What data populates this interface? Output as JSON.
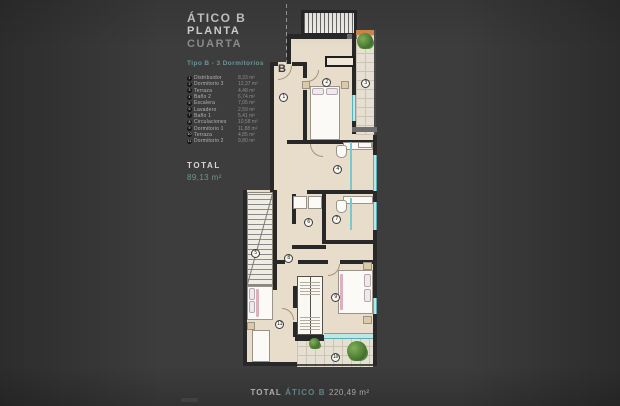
{
  "header": {
    "title": "ÁTICO B",
    "subtitle_primary": "PLANTA",
    "subtitle_accent": "CUARTA",
    "type_line": "Tipo B - 3 Dormitorios"
  },
  "legend": {
    "items": [
      {
        "num": "1",
        "name": "Distribuidor",
        "area": "8,33 m²"
      },
      {
        "num": "2",
        "name": "Dormitorio 3",
        "area": "12,37 m²"
      },
      {
        "num": "3",
        "name": "Terraza",
        "area": "4,48 m²"
      },
      {
        "num": "4",
        "name": "Baño 2",
        "area": "6,74 m²"
      },
      {
        "num": "5",
        "name": "Escalera",
        "area": "7,05 m²"
      },
      {
        "num": "6",
        "name": "Lavadero",
        "area": "2,59 m²"
      },
      {
        "num": "7",
        "name": "Baño 1",
        "area": "5,41 m²"
      },
      {
        "num": "8",
        "name": "Circulaciones",
        "area": "10,58 m²"
      },
      {
        "num": "9",
        "name": "Dormitorio 1",
        "area": "11,88 m²"
      },
      {
        "num": "10",
        "name": "Terraza",
        "area": "4,85 m²"
      },
      {
        "num": "11",
        "name": "Dormitorio 2",
        "area": "9,80 m²"
      }
    ]
  },
  "total": {
    "label": "TOTAL",
    "value": "89,13 m²"
  },
  "footer": {
    "label": "TOTAL",
    "accent": "ÁTICO B",
    "value": "220,49 m²"
  },
  "plan": {
    "section_marker": "B",
    "markers": [
      "1",
      "2",
      "3",
      "4",
      "5",
      "6",
      "7",
      "8",
      "9",
      "10",
      "11"
    ]
  },
  "colors": {
    "accent": "#6d9496",
    "floor": "#e8ddcb",
    "wall": "#282828",
    "glass": "#bfe6e7",
    "wood": "#cf8a4e",
    "plant": "#4e7d38"
  }
}
